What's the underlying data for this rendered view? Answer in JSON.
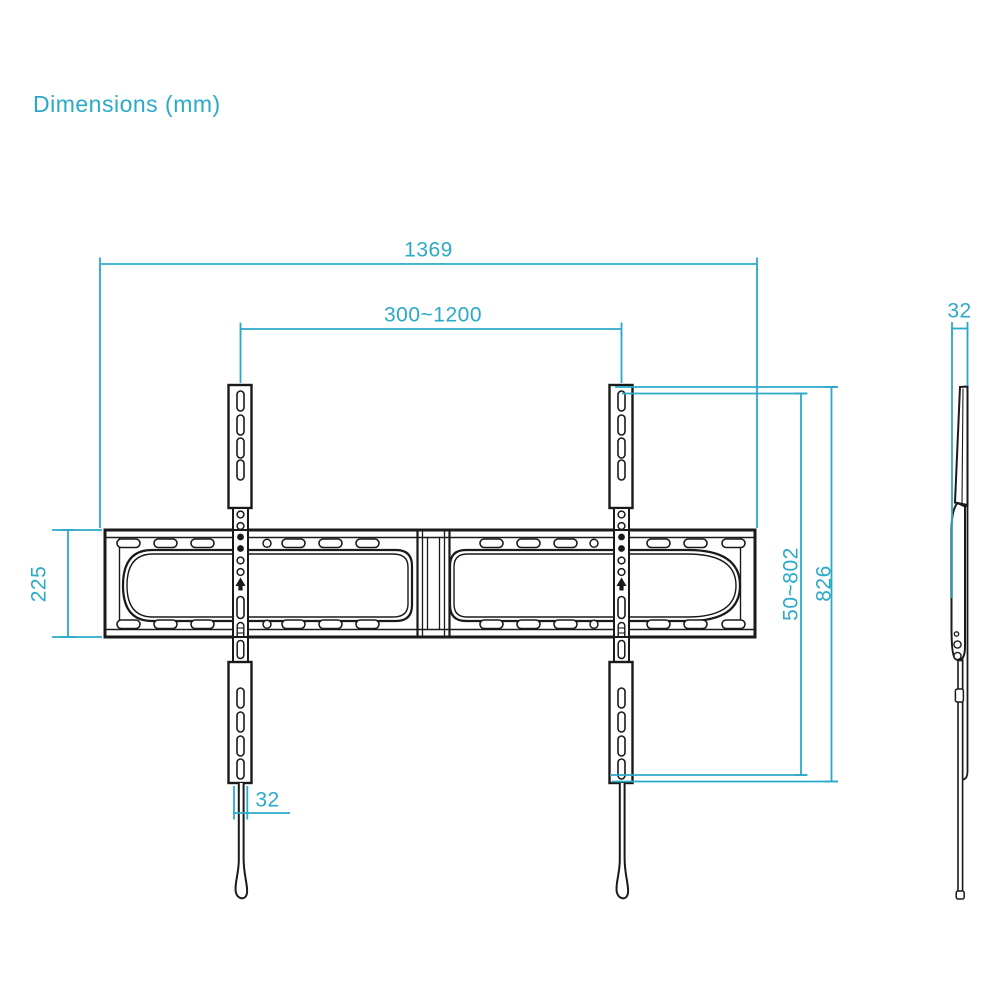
{
  "title": "Dimensions (mm)",
  "colors": {
    "accent": "#2BA9C8",
    "line": "#1A1A1A",
    "background": "#FFFFFF"
  },
  "dimensions": {
    "total_width": "1369",
    "rail_span_range": "300~1200",
    "plate_height": "225",
    "rail_width": "32",
    "height_adjust_range": "50~802",
    "rail_height": "826",
    "side_depth": "32"
  }
}
